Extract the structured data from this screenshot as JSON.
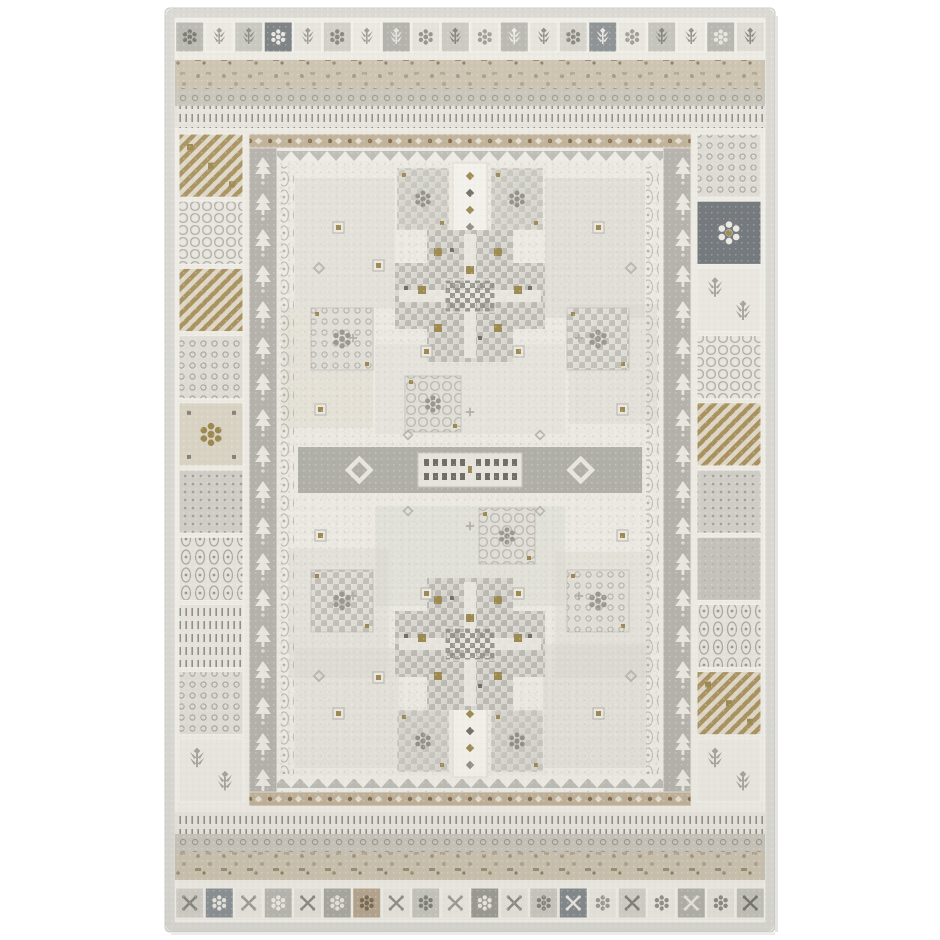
{
  "scene": {
    "kind": "product-photo",
    "subject": "traditional tribal patchwork area rug, faded ivory and gray with beige, tan and gold accents",
    "background": "#ffffff"
  },
  "palette": {
    "page_background": "#ffffff",
    "ivory": "#eae8e0",
    "ivory_light": "#f2f0e9",
    "gray_light": "#cfcec6",
    "gray": "#b3b2aa",
    "gray_mid": "#98978f",
    "gray_dark": "#7c7b74",
    "slate": "#71767a",
    "beige": "#c9c0ac",
    "tan": "#b3a283",
    "brown": "#85704f",
    "gold": "#9c8850",
    "selvage": "#d8d7d1",
    "field": "#ebe9e1",
    "ink": "#6f6e67"
  },
  "rug": {
    "x": 165,
    "y": 8,
    "width": 610,
    "height": 924,
    "top_squares": [
      {
        "bg": "#b7b6af",
        "fg": "#75746d",
        "m": "rosette"
      },
      {
        "bg": "#e9e7df",
        "fg": "#9a9992",
        "m": "sprig"
      },
      {
        "bg": "#c6c5bd",
        "fg": "#8b8a82",
        "m": "sprig"
      },
      {
        "bg": "#787d80",
        "fg": "#e8e6de",
        "m": "rosette"
      },
      {
        "bg": "#e5e3db",
        "fg": "#9a9992",
        "m": "sprig"
      },
      {
        "bg": "#cfcdc5",
        "fg": "#84837c",
        "m": "rosette"
      },
      {
        "bg": "#e9e7df",
        "fg": "#9a9992",
        "m": "sprig"
      },
      {
        "bg": "#b0afa8",
        "fg": "#e6e4dc",
        "m": "sprig"
      },
      {
        "bg": "#e2e0d8",
        "fg": "#908f88",
        "m": "rosette"
      },
      {
        "bg": "#c9c7bf",
        "fg": "#807f78",
        "m": "sprig"
      },
      {
        "bg": "#e7e5dd",
        "fg": "#9a9992",
        "m": "rosette"
      },
      {
        "bg": "#b7b6af",
        "fg": "#eceae2",
        "m": "sprig"
      },
      {
        "bg": "#e4e2da",
        "fg": "#8b8a82",
        "m": "sprig"
      },
      {
        "bg": "#d4d2ca",
        "fg": "#84837c",
        "m": "rosette"
      },
      {
        "bg": "#898e91",
        "fg": "#e8e6de",
        "m": "sprig"
      },
      {
        "bg": "#e7e5dd",
        "fg": "#9a9992",
        "m": "rosette"
      },
      {
        "bg": "#c2c1b9",
        "fg": "#807f78",
        "m": "sprig"
      },
      {
        "bg": "#e9e7df",
        "fg": "#908f88",
        "m": "sprig"
      },
      {
        "bg": "#b4b3ac",
        "fg": "#e6e4dc",
        "m": "rosette"
      },
      {
        "bg": "#dcdad2",
        "fg": "#84837c",
        "m": "sprig"
      }
    ],
    "bottom_squares": [
      {
        "bg": "#cfcdc5",
        "fg": "#84837c",
        "m": "x"
      },
      {
        "bg": "#8a8f92",
        "fg": "#e8e6de",
        "m": "rosette"
      },
      {
        "bg": "#e7e5dd",
        "fg": "#9a9992",
        "m": "x"
      },
      {
        "bg": "#b7b6af",
        "fg": "#eceae2",
        "m": "rosette"
      },
      {
        "bg": "#e2e0d8",
        "fg": "#8b8a82",
        "m": "x"
      },
      {
        "bg": "#a8a7a0",
        "fg": "#e6e4dc",
        "m": "rosette"
      },
      {
        "bg": "#b5a58e",
        "fg": "#7a6a52",
        "m": "rosette"
      },
      {
        "bg": "#e7e5dd",
        "fg": "#908f88",
        "m": "x"
      },
      {
        "bg": "#c6c5bd",
        "fg": "#807f78",
        "m": "rosette"
      },
      {
        "bg": "#e9e7df",
        "fg": "#9a9992",
        "m": "x"
      },
      {
        "bg": "#9b9a93",
        "fg": "#e8e6de",
        "m": "rosette"
      },
      {
        "bg": "#e4e2da",
        "fg": "#8b8a82",
        "m": "x"
      },
      {
        "bg": "#c9c7bf",
        "fg": "#84837c",
        "m": "rosette"
      },
      {
        "bg": "#83888b",
        "fg": "#e8e6de",
        "m": "x"
      },
      {
        "bg": "#e7e5dd",
        "fg": "#9a9992",
        "m": "rosette"
      },
      {
        "bg": "#d1cfc7",
        "fg": "#807f78",
        "m": "x"
      },
      {
        "bg": "#e9e7df",
        "fg": "#908f88",
        "m": "rosette"
      },
      {
        "bg": "#b0afa8",
        "fg": "#e6e4dc",
        "m": "x"
      },
      {
        "bg": "#e2e0d8",
        "fg": "#8b8a82",
        "m": "rosette"
      },
      {
        "bg": "#c2c1b9",
        "fg": "#75746d",
        "m": "x"
      }
    ],
    "left_column_blocks": [
      "diag-gold",
      "honeycomb",
      "diag-tan",
      "dotgrid",
      "gold-rosette",
      "dots-dense",
      "chain",
      "ticks",
      "dotgrid",
      "sprig-block"
    ],
    "right_column_blocks": [
      "dotgrid",
      "slate-rosette",
      "sprig-block",
      "honeycomb",
      "diag-tan",
      "dots-dense",
      "wash",
      "chain",
      "diag-gold",
      "sprig-block"
    ],
    "field": {
      "x": 112,
      "y": 153,
      "w": 386,
      "h": 618,
      "motifs": [
        {
          "type": "patch",
          "x": 130,
          "y": 170,
          "w": 100,
          "h": 130,
          "color": "#d9d7cf",
          "opacity": 0.5
        },
        {
          "type": "patch",
          "x": 380,
          "y": 170,
          "w": 100,
          "h": 140,
          "color": "#d3d1c9",
          "opacity": 0.45
        },
        {
          "type": "patch",
          "x": 118,
          "y": 300,
          "w": 90,
          "h": 120,
          "color": "#d8d0bf",
          "opacity": 0.3
        },
        {
          "type": "patch",
          "x": 404,
          "y": 296,
          "w": 88,
          "h": 120,
          "color": "#d6d4cc",
          "opacity": 0.4
        },
        {
          "type": "patch",
          "x": 210,
          "y": 336,
          "w": 190,
          "h": 90,
          "color": "#dedcd4",
          "opacity": 0.45
        },
        {
          "type": "patch",
          "x": 210,
          "y": 498,
          "w": 190,
          "h": 100,
          "color": "#d8d6ce",
          "opacity": 0.45
        },
        {
          "type": "patch",
          "x": 124,
          "y": 540,
          "w": 100,
          "h": 130,
          "color": "#d5d3cb",
          "opacity": 0.35
        },
        {
          "type": "patch",
          "x": 390,
          "y": 544,
          "w": 96,
          "h": 126,
          "color": "#d9d7cf",
          "opacity": 0.45
        },
        {
          "type": "patch",
          "x": 130,
          "y": 640,
          "w": 104,
          "h": 120,
          "color": "#d7d5cd",
          "opacity": 0.4
        },
        {
          "type": "patch",
          "x": 378,
          "y": 636,
          "w": 104,
          "h": 124,
          "color": "#d2d0c8",
          "opacity": 0.4
        },
        {
          "type": "chain-column",
          "x": 116,
          "y": 158,
          "w": 13,
          "h": 608
        },
        {
          "type": "chain-column",
          "x": 481,
          "y": 158,
          "w": 13,
          "h": 608
        },
        {
          "type": "entry-strip",
          "x": 288,
          "y": 155,
          "w": 34,
          "h": 76
        },
        {
          "type": "entry-strip",
          "x": 288,
          "y": 693,
          "w": 34,
          "h": 76
        },
        {
          "type": "flank-block",
          "x": 232,
          "y": 160,
          "w": 52,
          "h": 62
        },
        {
          "type": "flank-block",
          "x": 326,
          "y": 160,
          "w": 52,
          "h": 62
        },
        {
          "type": "flank-block",
          "x": 232,
          "y": 702,
          "w": 52,
          "h": 62
        },
        {
          "type": "flank-block",
          "x": 326,
          "y": 702,
          "w": 52,
          "h": 62
        },
        {
          "type": "cross-medallion",
          "cx": 305,
          "cy": 288
        },
        {
          "type": "cross-medallion",
          "cx": 305,
          "cy": 636
        },
        {
          "type": "ornate-square",
          "x": 146,
          "y": 300,
          "s": 62,
          "variant": "dots"
        },
        {
          "type": "ornate-square",
          "x": 402,
          "y": 300,
          "s": 62,
          "variant": "checker"
        },
        {
          "type": "ornate-square",
          "x": 146,
          "y": 562,
          "s": 62,
          "variant": "checker"
        },
        {
          "type": "ornate-square",
          "x": 402,
          "y": 562,
          "s": 62,
          "variant": "dots"
        },
        {
          "type": "ornate-square",
          "x": 240,
          "y": 368,
          "s": 56,
          "variant": "lattice"
        },
        {
          "type": "ornate-square",
          "x": 314,
          "y": 500,
          "s": 56,
          "variant": "lattice"
        },
        {
          "type": "center-band",
          "x": 132,
          "y": 438,
          "w": 346,
          "h": 48
        },
        {
          "type": "gold-square",
          "x": 168,
          "y": 214
        },
        {
          "type": "gold-square",
          "x": 208,
          "y": 252
        },
        {
          "type": "gold-square",
          "x": 256,
          "y": 338
        },
        {
          "type": "gold-square",
          "x": 348,
          "y": 338
        },
        {
          "type": "gold-square",
          "x": 428,
          "y": 214
        },
        {
          "type": "gold-square",
          "x": 150,
          "y": 396
        },
        {
          "type": "gold-square",
          "x": 452,
          "y": 396
        },
        {
          "type": "gold-square",
          "x": 168,
          "y": 700
        },
        {
          "type": "gold-square",
          "x": 208,
          "y": 664
        },
        {
          "type": "gold-square",
          "x": 256,
          "y": 580
        },
        {
          "type": "gold-square",
          "x": 348,
          "y": 580
        },
        {
          "type": "gold-square",
          "x": 428,
          "y": 700
        },
        {
          "type": "gold-square",
          "x": 150,
          "y": 522
        },
        {
          "type": "gold-square",
          "x": 452,
          "y": 522
        },
        {
          "type": "diamond",
          "x": 146,
          "y": 252,
          "s": 16
        },
        {
          "type": "diamond",
          "x": 458,
          "y": 252,
          "s": 16
        },
        {
          "type": "diamond",
          "x": 236,
          "y": 420,
          "s": 14
        },
        {
          "type": "diamond",
          "x": 368,
          "y": 420,
          "s": 14
        },
        {
          "type": "diamond",
          "x": 146,
          "y": 660,
          "s": 16
        },
        {
          "type": "diamond",
          "x": 458,
          "y": 660,
          "s": 16
        },
        {
          "type": "diamond",
          "x": 236,
          "y": 496,
          "s": 14
        },
        {
          "type": "diamond",
          "x": 368,
          "y": 496,
          "s": 14
        },
        {
          "type": "plus",
          "x": 188,
          "y": 330,
          "s": 12
        },
        {
          "type": "plus",
          "x": 414,
          "y": 330,
          "s": 12
        },
        {
          "type": "plus",
          "x": 188,
          "y": 588,
          "s": 12
        },
        {
          "type": "plus",
          "x": 414,
          "y": 588,
          "s": 12
        },
        {
          "type": "plus",
          "x": 305,
          "y": 404,
          "s": 12
        },
        {
          "type": "plus",
          "x": 305,
          "y": 518,
          "s": 12
        }
      ]
    }
  }
}
